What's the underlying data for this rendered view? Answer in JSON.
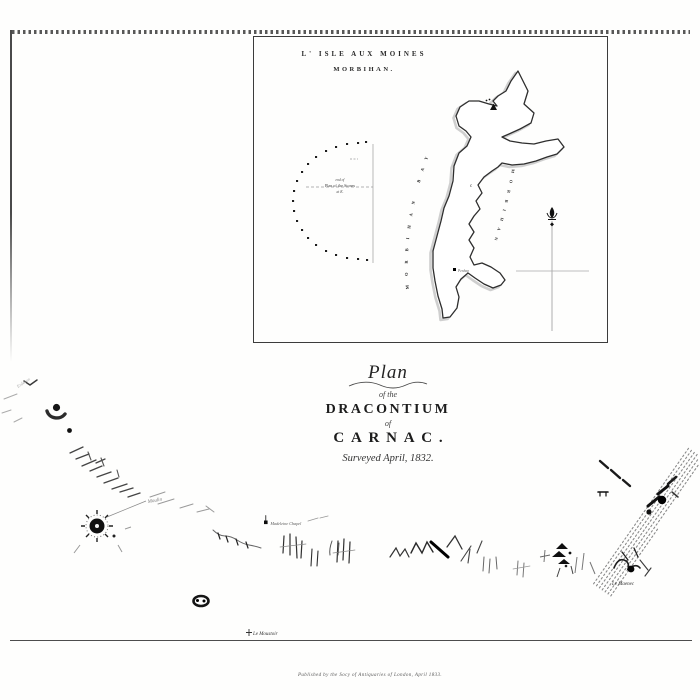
{
  "inset": {
    "title": "L' ISLE AUX MOINES",
    "subtitle": "MORBIHAN.",
    "note_line1": "end of",
    "note_line2": "Plan of the Stones",
    "note_line3": "at K.",
    "bay_text_west": "MORBIHAN BAY",
    "bay_text_east": "MORBIHAN",
    "island_letter": "c",
    "site_label": "Penhap"
  },
  "title_block": {
    "line1": "Plan",
    "line2": "of the",
    "line3": "DRACONTIUM",
    "line4": "of",
    "line5": "CARNAC.",
    "line6": "Surveyed April, 1832."
  },
  "map_labels": {
    "upper_left": "Erdeven",
    "tumulus": "Moulin",
    "chapel": "Madeleine Chapel",
    "bottom_site": "Le Moustoir",
    "right_site": "Le Maenec"
  },
  "imprint": "Published by the Socy of Antiquaries of London, April 1833.",
  "ink": {
    "dark": "#1c1c1c",
    "mid": "#4a4a4a",
    "faint": "#9a9a9a",
    "paper": "#fefefd"
  }
}
